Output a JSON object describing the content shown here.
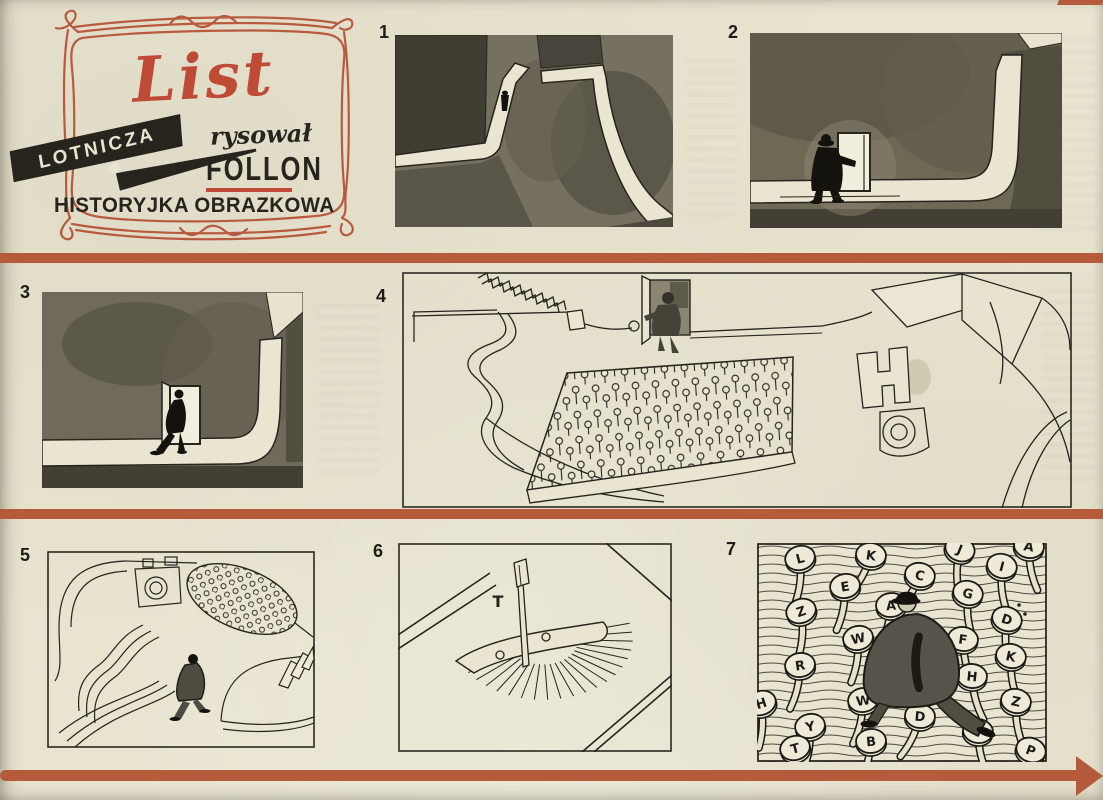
{
  "header": {
    "title": "List",
    "banner_label": "LOTNICZA",
    "credit_label": "rysował",
    "credit_name": "FOLLON",
    "subtitle": "HISTORYJKA OBRAZKOWA"
  },
  "colors": {
    "paper": "#e8e4d0",
    "bar_red": "#b65a3c",
    "title_red": "#bf4a35",
    "ink": "#26241c"
  },
  "panels": [
    {
      "number": "1"
    },
    {
      "number": "2"
    },
    {
      "number": "3"
    },
    {
      "number": "4"
    },
    {
      "number": "5"
    },
    {
      "number": "6"
    },
    {
      "number": "7"
    }
  ],
  "panel6": {
    "key_letter": "T"
  },
  "panel7": {
    "key_letters": [
      "L",
      "K",
      "J",
      "A",
      "E",
      "C",
      "I",
      "Z",
      "A",
      "G",
      "D",
      "W",
      "F",
      "R",
      "K",
      "H",
      "H",
      "W",
      "Z",
      "Y",
      "D",
      "B",
      "V",
      "T",
      "P"
    ]
  }
}
